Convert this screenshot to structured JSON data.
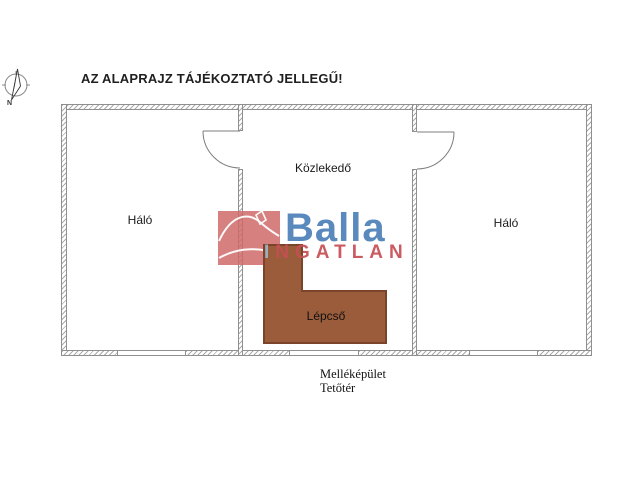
{
  "title": "AZ ALAPRAJZ TÁJÉKOZTATÓ JELLEGŰ!",
  "compass": {
    "north_label": "N"
  },
  "plan": {
    "rooms": [
      {
        "id": "bedroom-left",
        "label": "Háló"
      },
      {
        "id": "hallway",
        "label": "Közlekedő"
      },
      {
        "id": "bedroom-right",
        "label": "Háló"
      }
    ],
    "stairs": {
      "label": "Lépcső",
      "fill_color": "#9a5c3a",
      "border_color": "#7a432a"
    },
    "wall_line_color": "#8f8f8f"
  },
  "logo": {
    "brand": "Balla",
    "subtitle_first_letter": "I",
    "subtitle_rest": "NGATLAN",
    "brand_color": "#4d80b8",
    "subtitle_color": "#c64f54",
    "subtitle_first_color": "#9db4ca",
    "square_color": "#d06a6a",
    "icon": "house-roof-icon"
  },
  "footer": {
    "line1": "Melléképület",
    "line2": "Tetőtér"
  }
}
